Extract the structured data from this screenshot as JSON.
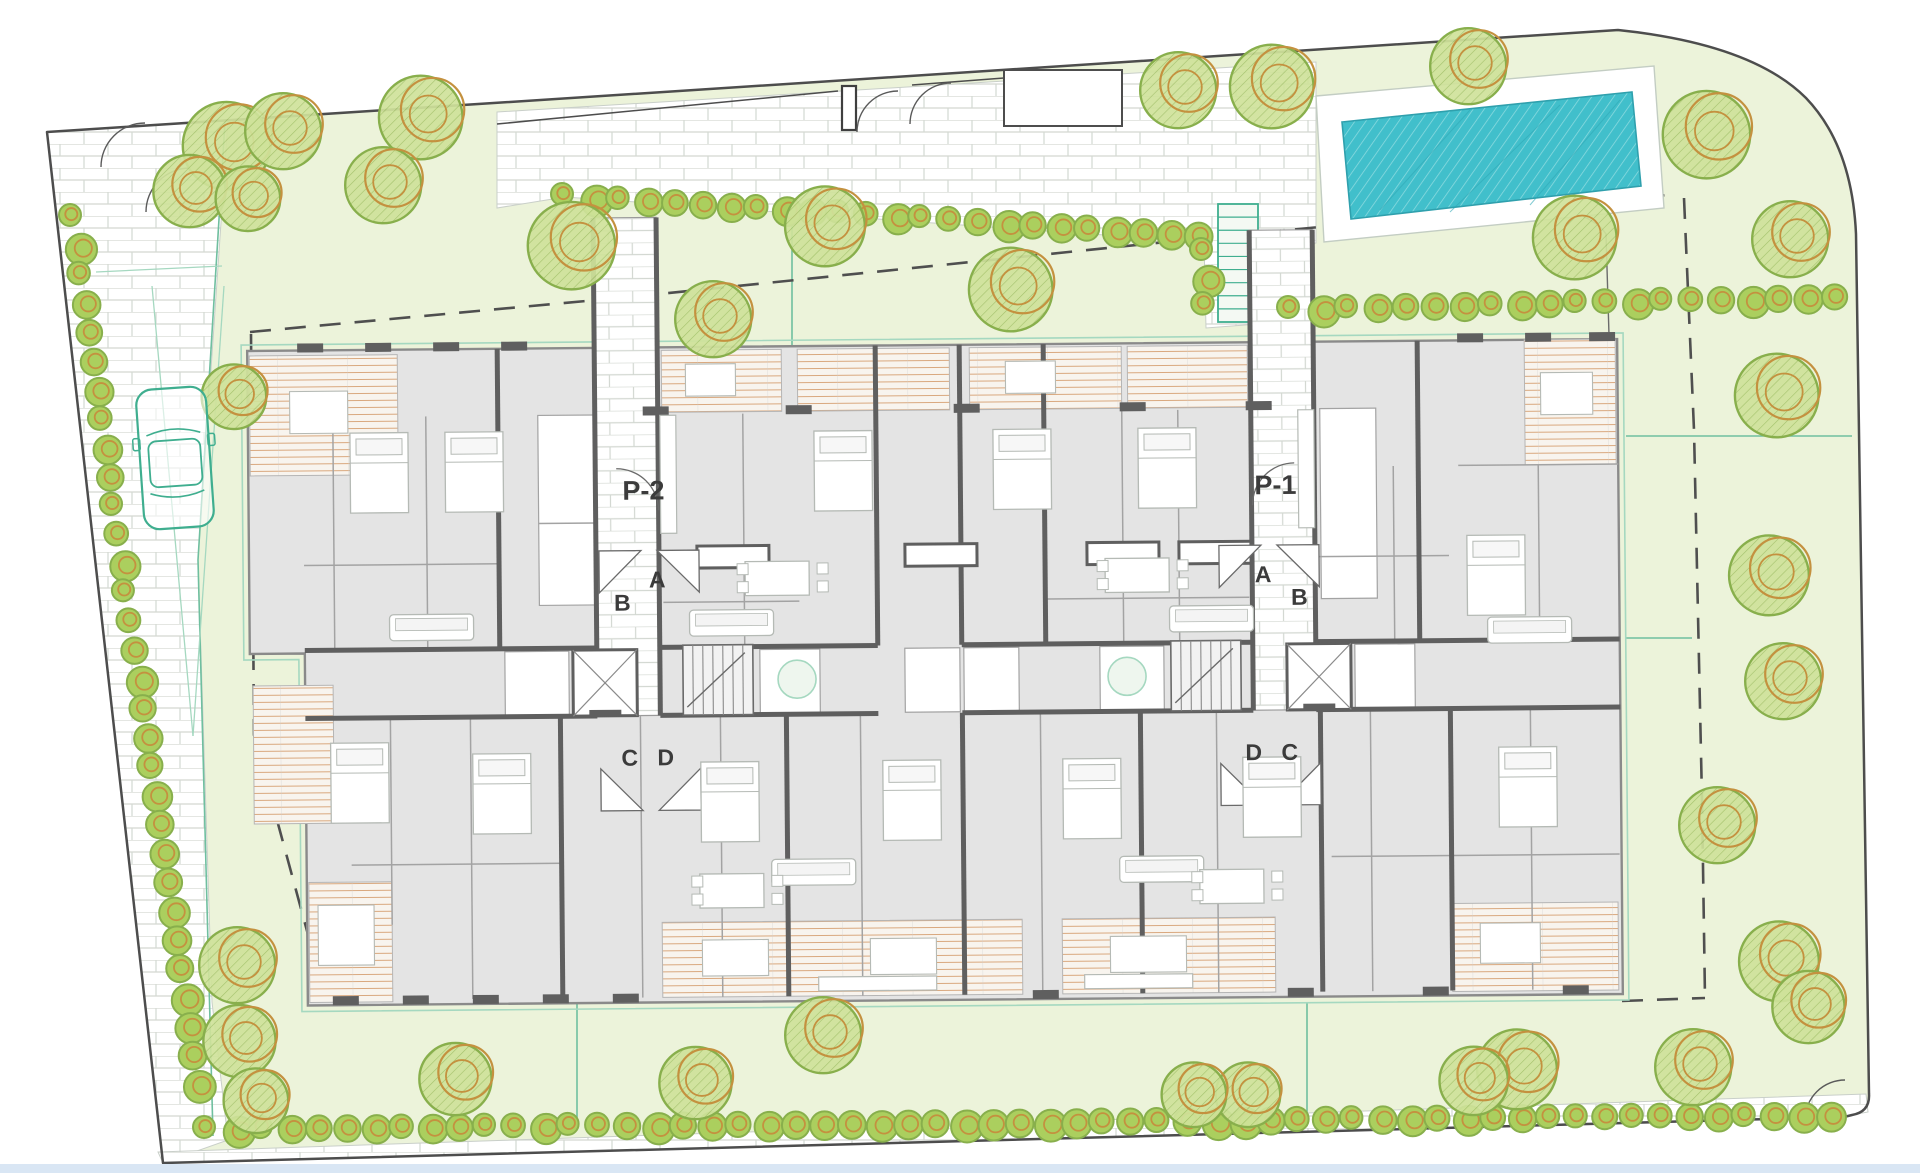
{
  "labels": {
    "p1": "P-1",
    "p2": "P-2",
    "a": "A",
    "b": "B",
    "c": "C",
    "d": "D"
  },
  "colors": {
    "lawn": "#ecf3da",
    "paving": "#ffffff",
    "brickLine": "#d3d8d2",
    "boundary": "#4d4d4d",
    "dash": "#4f4f4f",
    "teal": "#6fbf9f",
    "tealLight": "#a5d8c0",
    "poolWater": "#41bfcb",
    "poolHatch": "#8fdbe0",
    "poolEdge": "#2fa0ad",
    "treeFill": "#cfe29a",
    "treeGreen": "#88af4c",
    "treeOrange": "#c4913f",
    "treeHatch": "#9dbd62",
    "bushFill": "#abcf5e",
    "wall": "#5f5f5f",
    "wallThin": "#a3a3a3",
    "slab": "#e4e4e4",
    "room": "#ffffff",
    "deckFill": "#f8f4ee",
    "deckLine": "#d9a87e",
    "car": "#3fae8f",
    "label": "#3b3b3b",
    "bottomBand": "#d9e6f4",
    "furn": "#b5bab5"
  },
  "scene": {
    "site": {
      "boundary": "M47,132 L1618,30 Q1752,44 1806,98 Q1852,146 1856,234 L1869,1094 Q1870,1112 1852,1115 L1844,1117 L163,1163 Z",
      "paved": [
        {
          "name": "driveway-paving",
          "d": "M47,132 L228,120 L198,560 L212,1002 L228,1140 L163,1163 Z"
        },
        {
          "name": "entrance-plaza-paving",
          "d": "M497,112 L1316,62 L1316,243 L1262,246 L1258,324 L1206,328 L1204,242 L565,197 L497,208 Z"
        },
        {
          "name": "bottom-walkway-paving",
          "d": "M158,1152 L1866,1094 L1868,1112 L1846,1116 L163,1163 Z"
        }
      ],
      "poolDeck": "M1316,96 L1654,66 L1664,208 L1324,242 Z",
      "poolWater": "1342,122 1632,92 1641,186 1351,219",
      "poolStreaks": [
        [
          1380,
          210,
          1470,
          110
        ],
        [
          1450,
          212,
          1560,
          105
        ],
        [
          1530,
          205,
          1620,
          100
        ]
      ],
      "innerWallLines": [
        [
          497,
          124,
          838,
          91
        ],
        [
          912,
          85,
          1004,
          78
        ]
      ],
      "niche": [
        1004,
        70,
        118,
        56
      ],
      "gatePost": [
        842,
        86,
        14,
        44
      ],
      "arcs": [
        "M101,167 A44,44 0 0 1 145,123",
        "M146,212 A44,44 0 0 1 190,168",
        "M857,132 A41,41 0 0 1 898,91",
        "M951,83 A41,41 0 0 0 910,124",
        "M1805,1120 A40,40 0 0 1 1845,1080"
      ],
      "pathCurve": "M1495,198 Q1588,206 1606,234 L1612,436",
      "tealLines": [
        [
          792,
          215,
          792,
          348
        ],
        [
          577,
          1003,
          577,
          1128
        ],
        [
          1307,
          1003,
          1307,
          1126
        ],
        [
          1626,
          436,
          1852,
          436
        ],
        [
          1626,
          638,
          1692,
          638
        ],
        [
          225,
          122,
          198,
          560
        ],
        [
          198,
          560,
          213,
          1136
        ]
      ],
      "wedgeLines": [
        [
          152,
          286,
          193,
          736
        ],
        [
          224,
          286,
          193,
          736
        ],
        [
          96,
          272,
          222,
          266
        ]
      ],
      "dashedSetback": [
        "M250,332 L640,296 L1195,239 L1330,226 L1667,195",
        "M1684,198 L1694,430 L1702,800 L1705,998",
        "M1622,1001 L1705,998",
        "M251,334 L254,735 L313,953"
      ],
      "stair": {
        "x": 1218,
        "y": 204,
        "w": 40,
        "h": 118,
        "treads": 9
      },
      "bottomBand": [
        0,
        1164,
        1920,
        9
      ]
    },
    "trees": [
      [
        232,
        142,
        46
      ],
      [
        288,
        128,
        40
      ],
      [
        194,
        188,
        38
      ],
      [
        252,
        196,
        34
      ],
      [
        426,
        114,
        44
      ],
      [
        388,
        182,
        40
      ],
      [
        577,
        242,
        46
      ],
      [
        830,
        223,
        42
      ],
      [
        718,
        316,
        40
      ],
      [
        1016,
        286,
        44
      ],
      [
        238,
        394,
        34
      ],
      [
        1183,
        87,
        40
      ],
      [
        1277,
        83,
        44
      ],
      [
        1473,
        63,
        40
      ],
      [
        1712,
        131,
        46
      ],
      [
        1580,
        234,
        44
      ],
      [
        1795,
        236,
        40
      ],
      [
        1782,
        392,
        44
      ],
      [
        1774,
        572,
        42
      ],
      [
        1788,
        678,
        40
      ],
      [
        1722,
        822,
        40
      ],
      [
        1784,
        958,
        42
      ],
      [
        1813,
        1004,
        38
      ],
      [
        1698,
        1064,
        40
      ],
      [
        1522,
        1066,
        42
      ],
      [
        1478,
        1078,
        36
      ],
      [
        1252,
        1092,
        34
      ],
      [
        1198,
        1092,
        34
      ],
      [
        828,
        1032,
        40
      ],
      [
        700,
        1080,
        38
      ],
      [
        460,
        1076,
        38
      ],
      [
        242,
        962,
        40
      ],
      [
        244,
        1038,
        38
      ],
      [
        260,
        1098,
        34
      ]
    ],
    "hedges": [
      {
        "x1": 74,
        "y1": 218,
        "x2": 196,
        "y2": 1084,
        "n": 31
      },
      {
        "x1": 208,
        "y1": 1130,
        "x2": 1830,
        "y2": 1116,
        "n": 59
      },
      {
        "x1": 566,
        "y1": 197,
        "x2": 1198,
        "y2": 236,
        "n": 24
      },
      {
        "x1": 1205,
        "y1": 252,
        "x2": 1206,
        "y2": 306,
        "n": 3
      },
      {
        "x1": 1292,
        "y1": 310,
        "x2": 1836,
        "y2": 298,
        "n": 20
      }
    ],
    "car": {
      "x": 140,
      "y": 388,
      "w": 70,
      "h": 140
    },
    "building": {
      "footprint": "M250,345 L1620,345 L1620,1000 L305,1000 L305,648 L250,648 Z",
      "greenOutline": "M244,339 L1626,339 L1626,1006 L299,1006 L299,654 L244,654 Z",
      "decks": [
        [
          664,
          348,
          120,
          62
        ],
        [
          800,
          348,
          152,
          62
        ],
        [
          972,
          348,
          152,
          62
        ],
        [
          1130,
          348,
          120,
          62
        ],
        [
          252,
          350,
          148,
          120
        ],
        [
          1527,
          345,
          91,
          125
        ],
        [
          253,
          680,
          80,
          138
        ],
        [
          307,
          877,
          83,
          120
        ],
        [
          660,
          920,
          360,
          75
        ],
        [
          1060,
          920,
          213,
          75
        ],
        [
          1450,
          908,
          166,
          88
        ]
      ],
      "corridors": [
        [
          597,
          215,
          63,
          498
        ],
        [
          1253,
          233,
          63,
          480
        ]
      ],
      "darkV": [
        [
          500,
          345,
          645
        ],
        [
          878,
          345,
          645
        ],
        [
          962,
          345,
          645
        ],
        [
          1046,
          345,
          645
        ],
        [
          1420,
          345,
          645
        ],
        [
          597,
          215,
          713
        ],
        [
          660,
          215,
          713
        ],
        [
          1253,
          233,
          713
        ],
        [
          1316,
          233,
          713
        ],
        [
          560,
          713,
          995
        ],
        [
          786,
          713,
          995
        ],
        [
          962,
          713,
          995
        ],
        [
          1140,
          713,
          995
        ],
        [
          1320,
          713,
          995
        ],
        [
          1450,
          713,
          995
        ]
      ],
      "darkH": [
        [
          305,
          597,
          645
        ],
        [
          660,
          878,
          645
        ],
        [
          962,
          1253,
          645
        ],
        [
          1316,
          1620,
          645
        ],
        [
          305,
          597,
          713
        ],
        [
          660,
          878,
          713
        ],
        [
          962,
          1253,
          713
        ],
        [
          1316,
          1620,
          713
        ]
      ],
      "thinV": [
        [
          335,
          412,
          645
        ],
        [
          428,
          412,
          645
        ],
        [
          745,
          412,
          645
        ],
        [
          1124,
          412,
          645
        ],
        [
          1180,
          412,
          645
        ],
        [
          1395,
          470,
          645
        ],
        [
          1540,
          470,
          645
        ],
        [
          390,
          713,
          920
        ],
        [
          470,
          713,
          995
        ],
        [
          640,
          713,
          995
        ],
        [
          720,
          713,
          995
        ],
        [
          860,
          713,
          995
        ],
        [
          1040,
          713,
          995
        ],
        [
          1216,
          713,
          995
        ],
        [
          1370,
          713,
          995
        ],
        [
          1530,
          713,
          995
        ]
      ],
      "thinH": [
        [
          305,
          500,
          560
        ],
        [
          540,
          597,
          520
        ],
        [
          664,
          800,
          600
        ],
        [
          1048,
          1250,
          600
        ],
        [
          1320,
          1450,
          560
        ],
        [
          1460,
          1620,
          470
        ],
        [
          350,
          560,
          860
        ],
        [
          1330,
          1618,
          860
        ]
      ],
      "whiteRooms": [
        [
          540,
          412,
          56,
          190
        ],
        [
          1322,
          412,
          56,
          190
        ],
        [
          505,
          648,
          64,
          64
        ],
        [
          760,
          648,
          60,
          64
        ],
        [
          905,
          648,
          55,
          64
        ],
        [
          964,
          648,
          55,
          64
        ],
        [
          1100,
          648,
          64,
          64
        ],
        [
          1355,
          648,
          60,
          64
        ]
      ],
      "piers": [
        [
          300,
          338
        ],
        [
          368,
          338
        ],
        [
          436,
          338
        ],
        [
          504,
          338
        ],
        [
          645,
          404
        ],
        [
          788,
          404
        ],
        [
          956,
          404
        ],
        [
          1122,
          404
        ],
        [
          1248,
          404
        ],
        [
          1460,
          338
        ],
        [
          1528,
          338
        ],
        [
          1592,
          338
        ],
        [
          330,
          991
        ],
        [
          400,
          991
        ],
        [
          470,
          991
        ],
        [
          540,
          991
        ],
        [
          610,
          991
        ],
        [
          1030,
          991
        ],
        [
          1285,
          991
        ],
        [
          1420,
          991
        ],
        [
          1560,
          991
        ]
      ],
      "elevators": [
        [
          573,
          647
        ],
        [
          1287,
          647
        ]
      ],
      "stairs": [
        [
          683,
          643
        ],
        [
          1171,
          643
        ]
      ],
      "circles": [
        [
          797,
          678,
          19
        ],
        [
          1127,
          678,
          19
        ]
      ],
      "winBlocks": [
        [
          698,
          544
        ],
        [
          906,
          544
        ],
        [
          1088,
          544
        ],
        [
          1180,
          544
        ]
      ],
      "triangles": [
        [
          600,
          548,
          642,
          548,
          600,
          590
        ],
        [
          658,
          548,
          700,
          548,
          700,
          590
        ],
        [
          600,
          808,
          642,
          808,
          600,
          766
        ],
        [
          658,
          808,
          700,
          808,
          700,
          766
        ],
        [
          1320,
          548,
          1278,
          548,
          1320,
          590
        ],
        [
          1262,
          548,
          1220,
          548,
          1220,
          590
        ],
        [
          1320,
          808,
          1278,
          808,
          1320,
          766
        ],
        [
          1262,
          808,
          1220,
          808,
          1220,
          766
        ]
      ],
      "doorArcs": [
        "M618,466 A42,42 0 0 1 660,508",
        "M1296,466 A42,42 0 0 0 1254,508"
      ],
      "furniture": {
        "beds": [
          [
            352,
            428
          ],
          [
            447,
            428
          ],
          [
            816,
            430
          ],
          [
            995,
            430
          ],
          [
            1140,
            430
          ],
          [
            1468,
            540
          ],
          [
            330,
            738
          ],
          [
            472,
            750
          ],
          [
            700,
            760
          ],
          [
            882,
            760
          ],
          [
            1062,
            760
          ],
          [
            1242,
            760
          ],
          [
            1498,
            752
          ]
        ],
        "sofas": [
          [
            690,
            608
          ],
          [
            1170,
            608
          ],
          [
            390,
            610
          ],
          [
            1488,
            622
          ],
          [
            770,
            858
          ],
          [
            1118,
            858
          ]
        ],
        "tables": [
          [
            746,
            560
          ],
          [
            1106,
            560
          ],
          [
            698,
            872
          ],
          [
            1198,
            872
          ]
        ],
        "kitchens": [
          [
            662,
            413,
            16,
            118
          ],
          [
            1300,
            413,
            16,
            118
          ],
          [
            816,
            976,
            118,
            14
          ],
          [
            1082,
            976,
            108,
            14
          ]
        ],
        "deckFurn": [
          [
            700,
            938,
            66,
            36
          ],
          [
            868,
            938,
            66,
            36
          ],
          [
            1108,
            938,
            76,
            36
          ],
          [
            292,
            386,
            58,
            42
          ],
          [
            1543,
            378,
            52,
            42
          ],
          [
            688,
            362,
            50,
            32
          ],
          [
            1008,
            362,
            50,
            32
          ],
          [
            1478,
            928,
            60,
            40
          ],
          [
            316,
            900,
            56,
            60
          ]
        ]
      }
    },
    "planLabels": [
      {
        "bind": "labels.p2",
        "name": "label-p2",
        "x": 645,
        "y": 497,
        "fs": 27
      },
      {
        "bind": "labels.p1",
        "name": "label-p1",
        "x": 1277,
        "y": 497,
        "fs": 27
      },
      {
        "bind": "labels.a",
        "name": "label-a-left",
        "x": 658,
        "y": 585,
        "fs": 23
      },
      {
        "bind": "labels.b",
        "name": "label-b-left",
        "x": 623,
        "y": 608,
        "fs": 23
      },
      {
        "bind": "labels.c",
        "name": "label-c-left",
        "x": 629,
        "y": 763,
        "fs": 23
      },
      {
        "bind": "labels.d",
        "name": "label-d-left",
        "x": 665,
        "y": 763,
        "fs": 23
      },
      {
        "bind": "labels.a",
        "name": "label-a-right",
        "x": 1264,
        "y": 585,
        "fs": 23
      },
      {
        "bind": "labels.b",
        "name": "label-b-right",
        "x": 1300,
        "y": 608,
        "fs": 23
      },
      {
        "bind": "labels.c",
        "name": "label-c-right",
        "x": 1289,
        "y": 763,
        "fs": 23
      },
      {
        "bind": "labels.d",
        "name": "label-d-right",
        "x": 1253,
        "y": 763,
        "fs": 23
      }
    ]
  }
}
